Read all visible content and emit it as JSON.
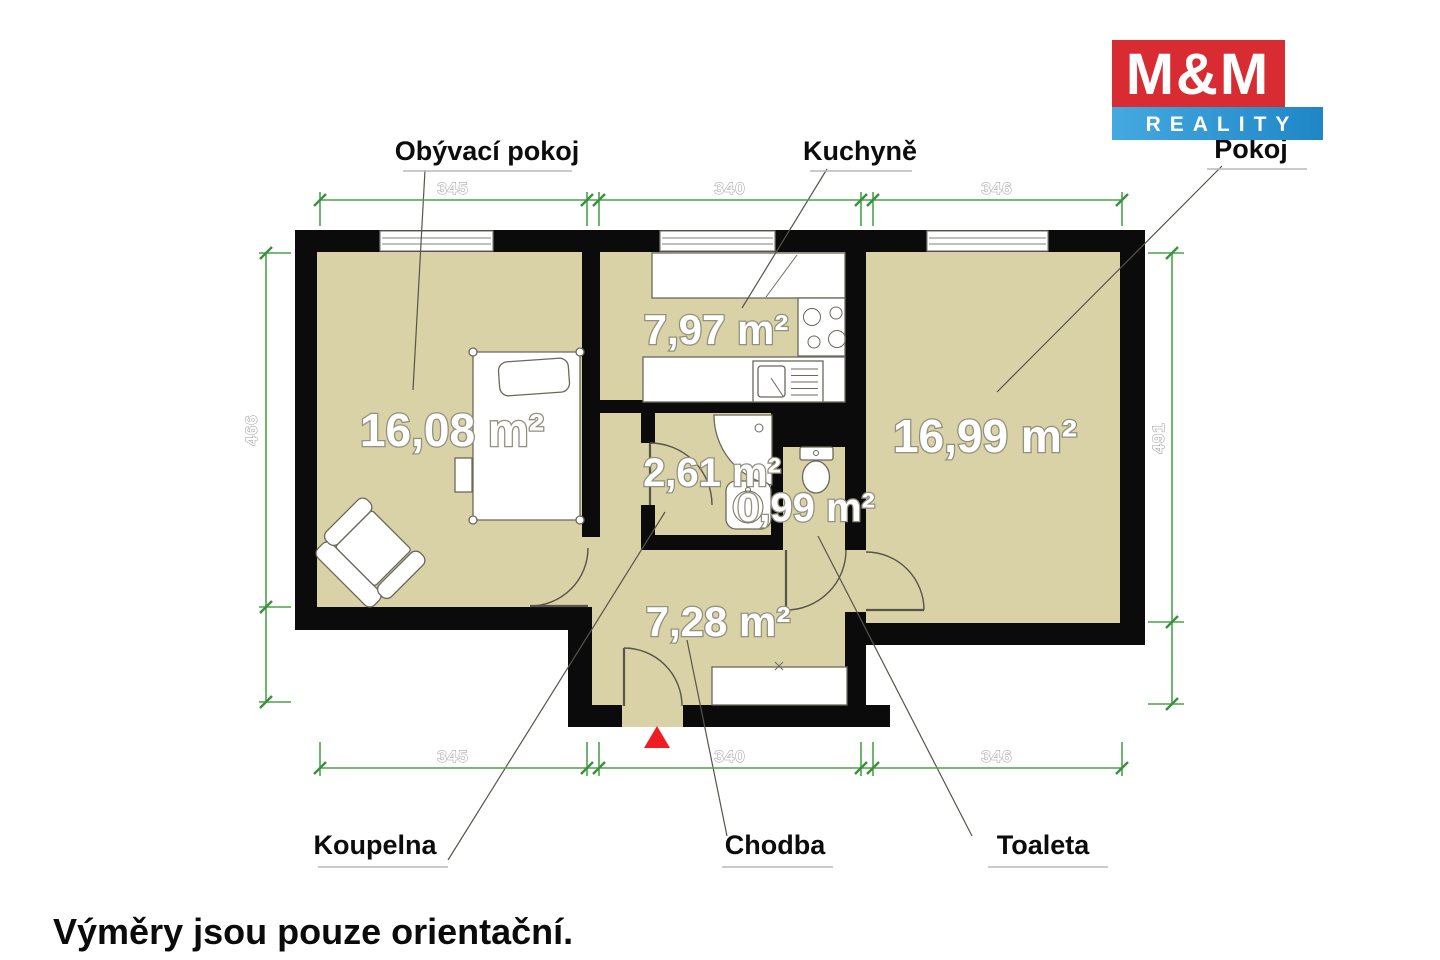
{
  "logo": {
    "line1": "M&M",
    "line2": "REALITY",
    "red": "#d92b32",
    "blue_from": "#45a9e0",
    "blue_to": "#1f86c6"
  },
  "meta": {
    "disclaimer": "Výměry jsou pouze orientační."
  },
  "rooms": {
    "living": {
      "name": "Obývací pokoj",
      "area": "16,08 m²"
    },
    "kitchen": {
      "name": "Kuchyně",
      "area": "7,97 m²"
    },
    "bedroom": {
      "name": "Pokoj",
      "area": "16,99 m²"
    },
    "bathroom": {
      "name": "Koupelna",
      "area": "2,61 m²"
    },
    "hall": {
      "name": "Chodba",
      "area": "7,28 m²"
    },
    "toilet": {
      "name": "Toaleta",
      "area": "0,99 m²"
    }
  },
  "dimensions": {
    "top": [
      "345",
      "340",
      "346"
    ],
    "bottom": [
      "345",
      "340",
      "346"
    ],
    "left": "466",
    "right": "491"
  },
  "colors": {
    "floor": "#d9d2a6",
    "wall": "#0b0b0b",
    "dimension_line": "#4aa34a",
    "entrance_marker": "#ee1c23"
  }
}
